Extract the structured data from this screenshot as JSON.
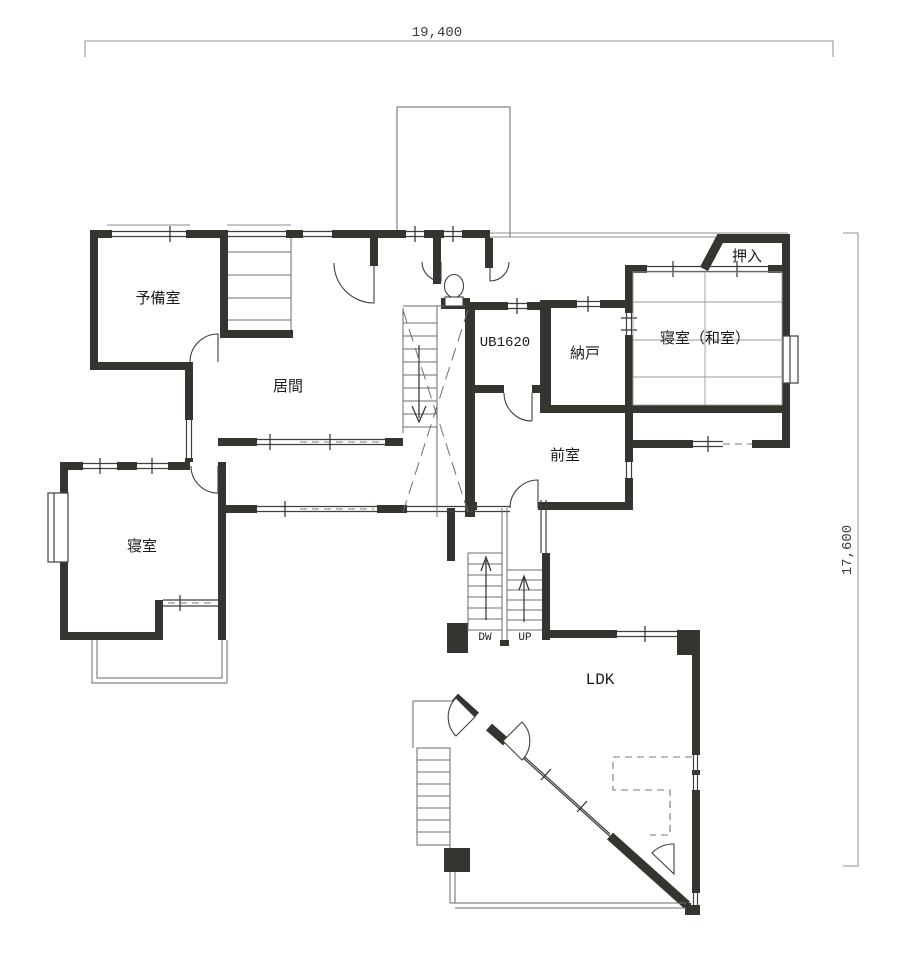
{
  "dimensions": {
    "width_label": "19,400",
    "height_label": "17,600"
  },
  "rooms": {
    "spare": "予備室",
    "living": "居間",
    "unit_bath": "UB1620",
    "storage": "納戸",
    "bedroom_washitsu": "寝室（和室）",
    "closet": "押入",
    "anteroom": "前室",
    "bedroom": "寝室",
    "ldk": "LDK"
  },
  "stairs": {
    "down": "DW",
    "up": "UP"
  },
  "colors": {
    "wall": "#32362f",
    "thin_line": "#6a6a6a",
    "background": "#ffffff"
  }
}
